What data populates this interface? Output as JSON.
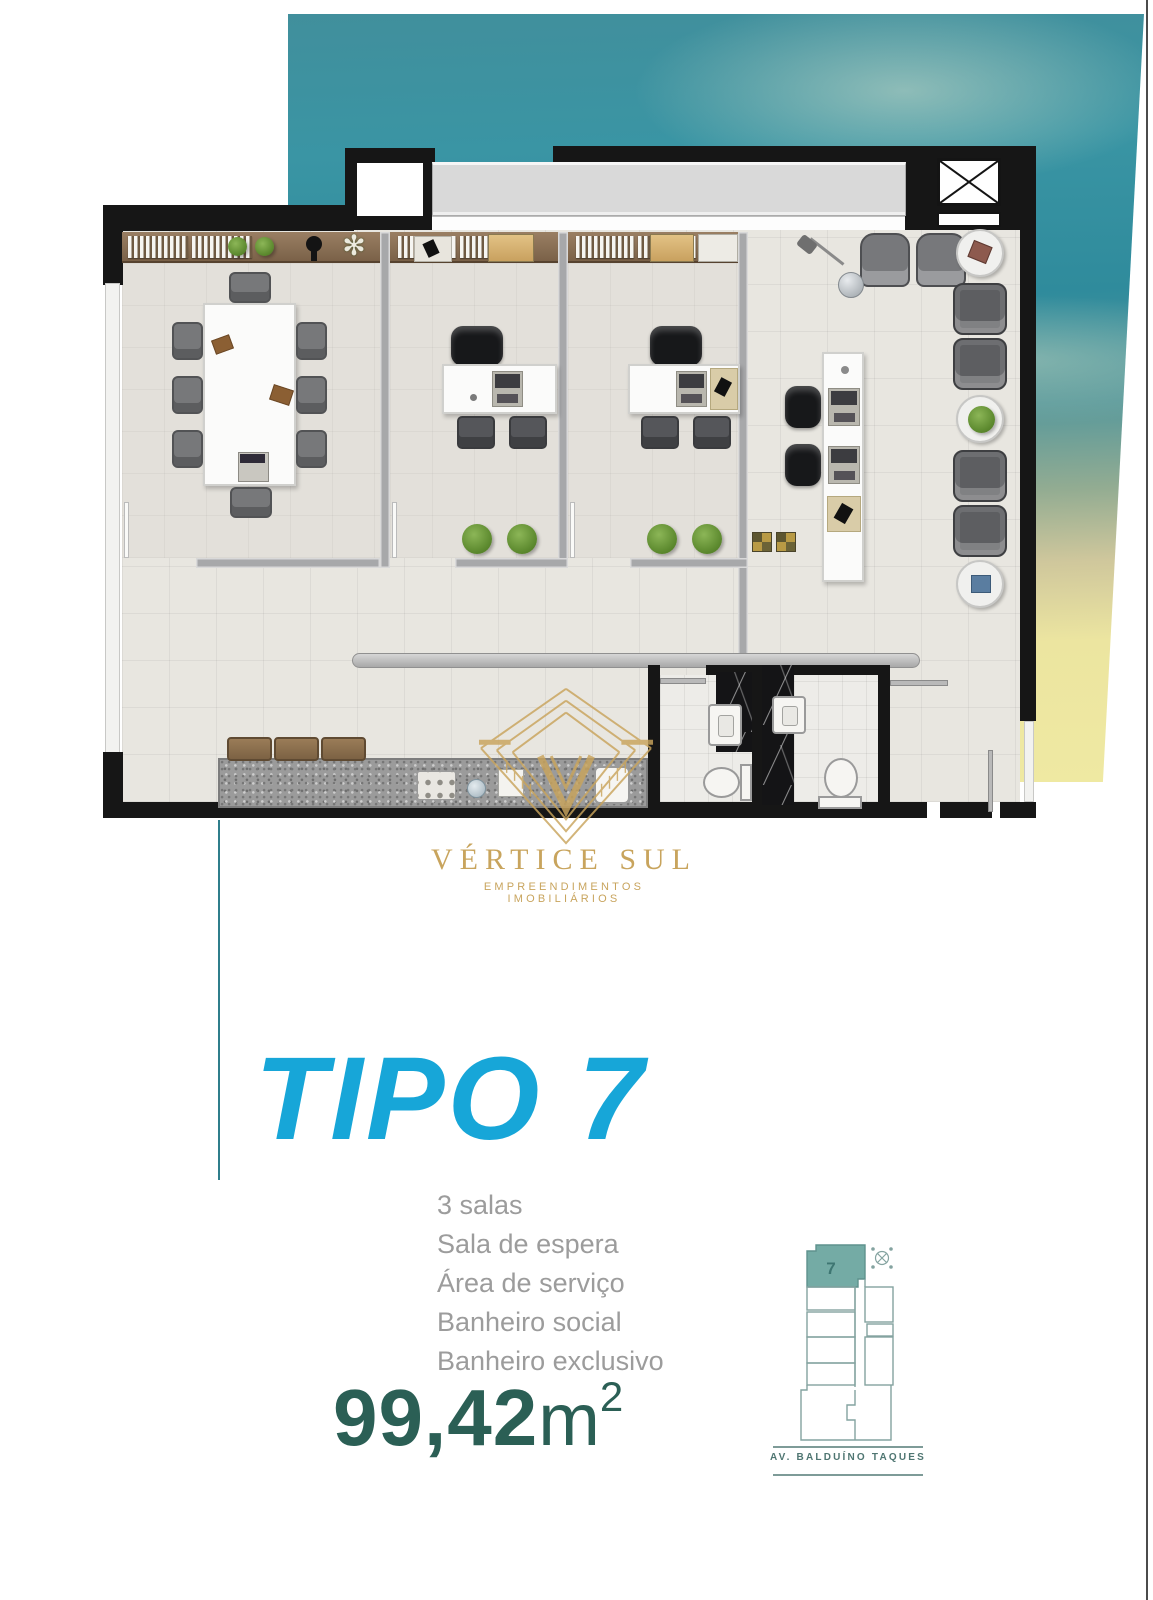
{
  "logo": {
    "name": "VÉRTICE SUL",
    "tagline": "EMPREENDIMENTOS IMOBILIÁRIOS"
  },
  "unit": {
    "title": "TIPO 7",
    "features": [
      "3 salas",
      "Sala de espera",
      "Área de serviço",
      "Banheiro social",
      "Banheiro exclusivo"
    ],
    "area": {
      "value": "99,42",
      "unit": "m",
      "exponent": "2"
    }
  },
  "minimap": {
    "unit_number": "7",
    "street_label": "AV. BALDUÍNO TAQUES"
  },
  "icons": {
    "flower_glyph": "✻"
  },
  "colors": {
    "accent": "#17A6D8",
    "area_text": "#2B5F55",
    "feature_text": "#9C9C9C",
    "logo_gold": "#C8A45D",
    "divider_teal": "#2F7E8B",
    "sky_teal": "#3892A1",
    "sky_yellow": "#EFE9A2",
    "map_unit_fill": "#74ABA5",
    "map_stroke": "#84A3A0"
  }
}
